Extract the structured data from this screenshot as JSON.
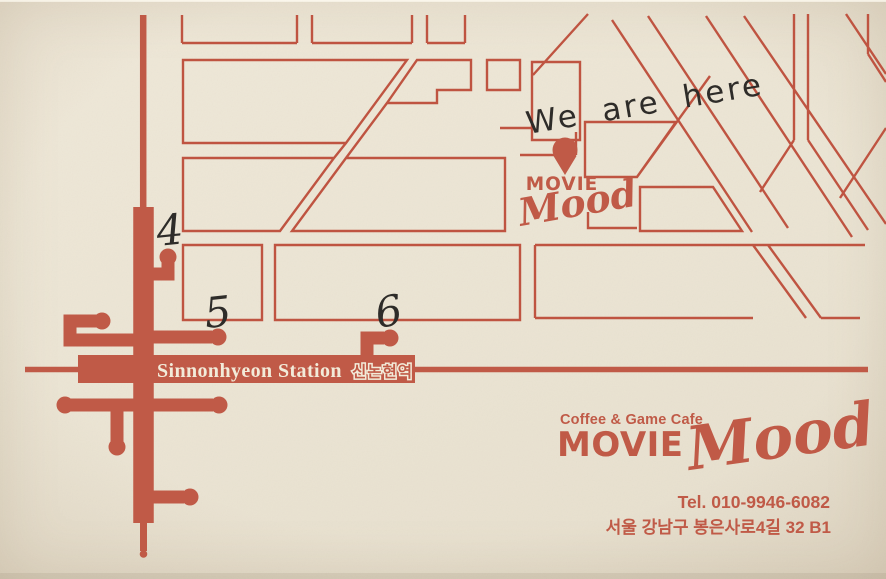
{
  "palette": {
    "paper": "#ebe4d3",
    "terracotta": "#c05a47",
    "street_line": "#bf5441",
    "ink": "#2e2c29",
    "cream": "#f2ebd9"
  },
  "map": {
    "annotation": {
      "we_are_here": "We are here"
    },
    "exits": {
      "e4": "4",
      "e5": "5",
      "e6": "6"
    },
    "station": {
      "name_en": "Sinnonhyeon Station",
      "name_ko": "신논현역"
    }
  },
  "logo_small": {
    "movie": "MOVIE",
    "mood": "Mood"
  },
  "logo_large": {
    "tagline": "Coffee & Game Cafe",
    "movie": "MOVIE",
    "mood": "Mood"
  },
  "contact": {
    "phone": "Tel. 010-9946-6082",
    "address": "서울 강남구 봉은사로4길 32 B1"
  }
}
